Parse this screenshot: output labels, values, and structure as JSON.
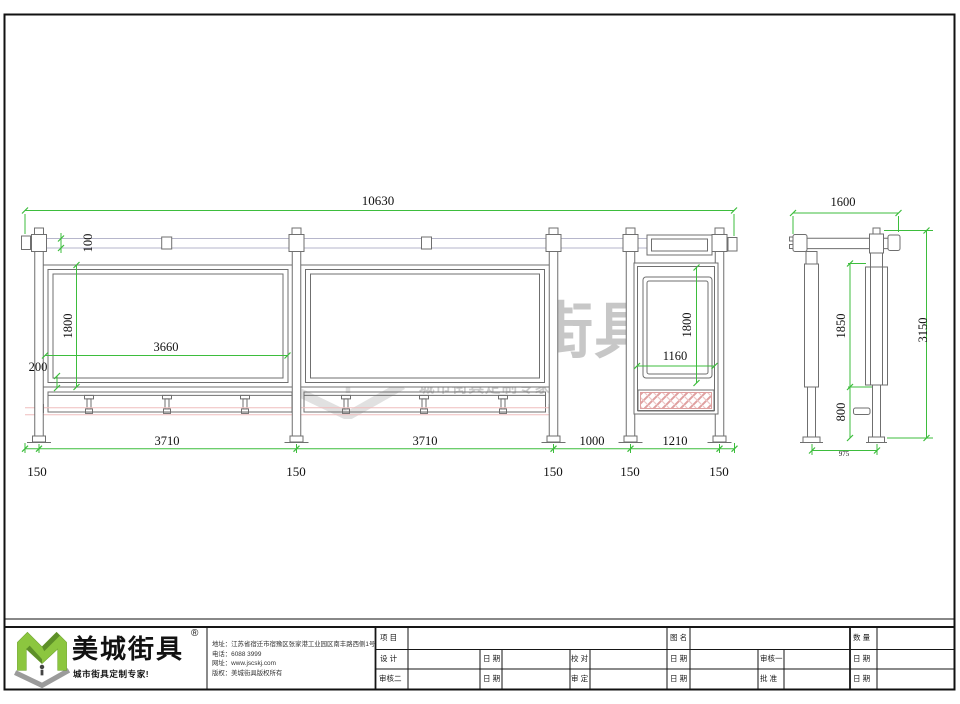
{
  "watermark": {
    "brand": "美城街具",
    "registered": "®",
    "tagline": "城市街具定制专家！"
  },
  "front_view": {
    "overall_width": "10630",
    "beam_height": "100",
    "panel_height": "1800",
    "panel_width": "3660",
    "panel_bottom_offset": "200",
    "bay_widths": [
      "3710",
      "3710",
      "1000",
      "1210"
    ],
    "post_offsets": [
      "150",
      "150",
      "150",
      "150",
      "150"
    ],
    "lightbox_height": "1800",
    "lightbox_width": "1160"
  },
  "side_view": {
    "overall_width": "1600",
    "upper_height": "1850",
    "lower_height": "800",
    "total_height": "3150",
    "base_width": "975"
  },
  "logo": {
    "brand": "美城街具",
    "registered": "®",
    "tagline": "城市街具定制专家!"
  },
  "contact": {
    "lines": [
      "地址：江苏省宿迁市宿豫区张家港工业园区南丰路西侧1号",
      "电话：6088 3999",
      "网址：www.jscskj.com",
      "版权：美城街具版权所有"
    ]
  },
  "title_block": {
    "project": "项 目",
    "drawing_name": "图 名",
    "quantity": "数 量",
    "design": "设 计",
    "proofread": "校 对",
    "review1": "审核一",
    "review2": "审核二",
    "verify": "审 定",
    "approve": "批 准",
    "date": "日 期"
  },
  "colors": {
    "dimension_green": "#3dbd3d",
    "bench_rail_pink": "#efbdbd",
    "logo_green": "#8cc63f",
    "line_gray": "#6f6f6f"
  }
}
